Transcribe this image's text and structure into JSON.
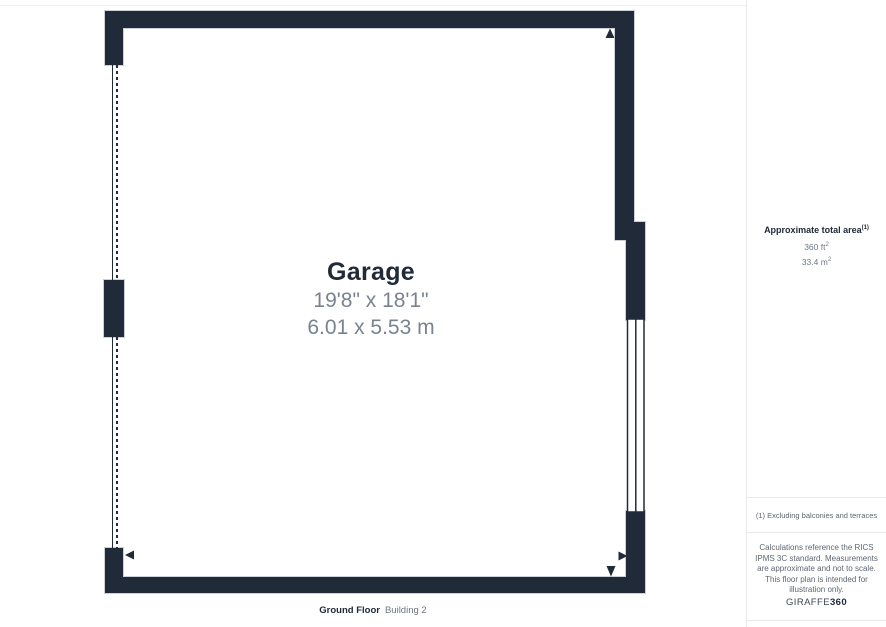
{
  "floor_plan": {
    "room": {
      "name": "Garage",
      "dimensions_imperial": "19'8\" x 18'1\"",
      "dimensions_metric": "6.01 x 5.53 m"
    },
    "footer": {
      "floor_label": "Ground Floor",
      "building_label": "Building 2"
    }
  },
  "sidebar": {
    "area": {
      "title": "Approximate total area",
      "footnote_marker": "(1)",
      "imperial_value": "360 ft",
      "imperial_unit_sup": "2",
      "metric_value": "33.4 m",
      "metric_unit_sup": "2"
    },
    "footnote": "(1) Excluding balconies and terraces",
    "disclaimer": "Calculations reference the RICS IPMS 3C standard. Measurements are approximate and not to scale. This floor plan is intended for illustration only.",
    "brand": {
      "name": "GIRAFFE",
      "suffix": "360"
    }
  },
  "colors": {
    "wall": "#202a38",
    "wall_outline": "#ccd1d8",
    "dimension_text": "#7a828f",
    "divider": "#e7e9ec"
  }
}
